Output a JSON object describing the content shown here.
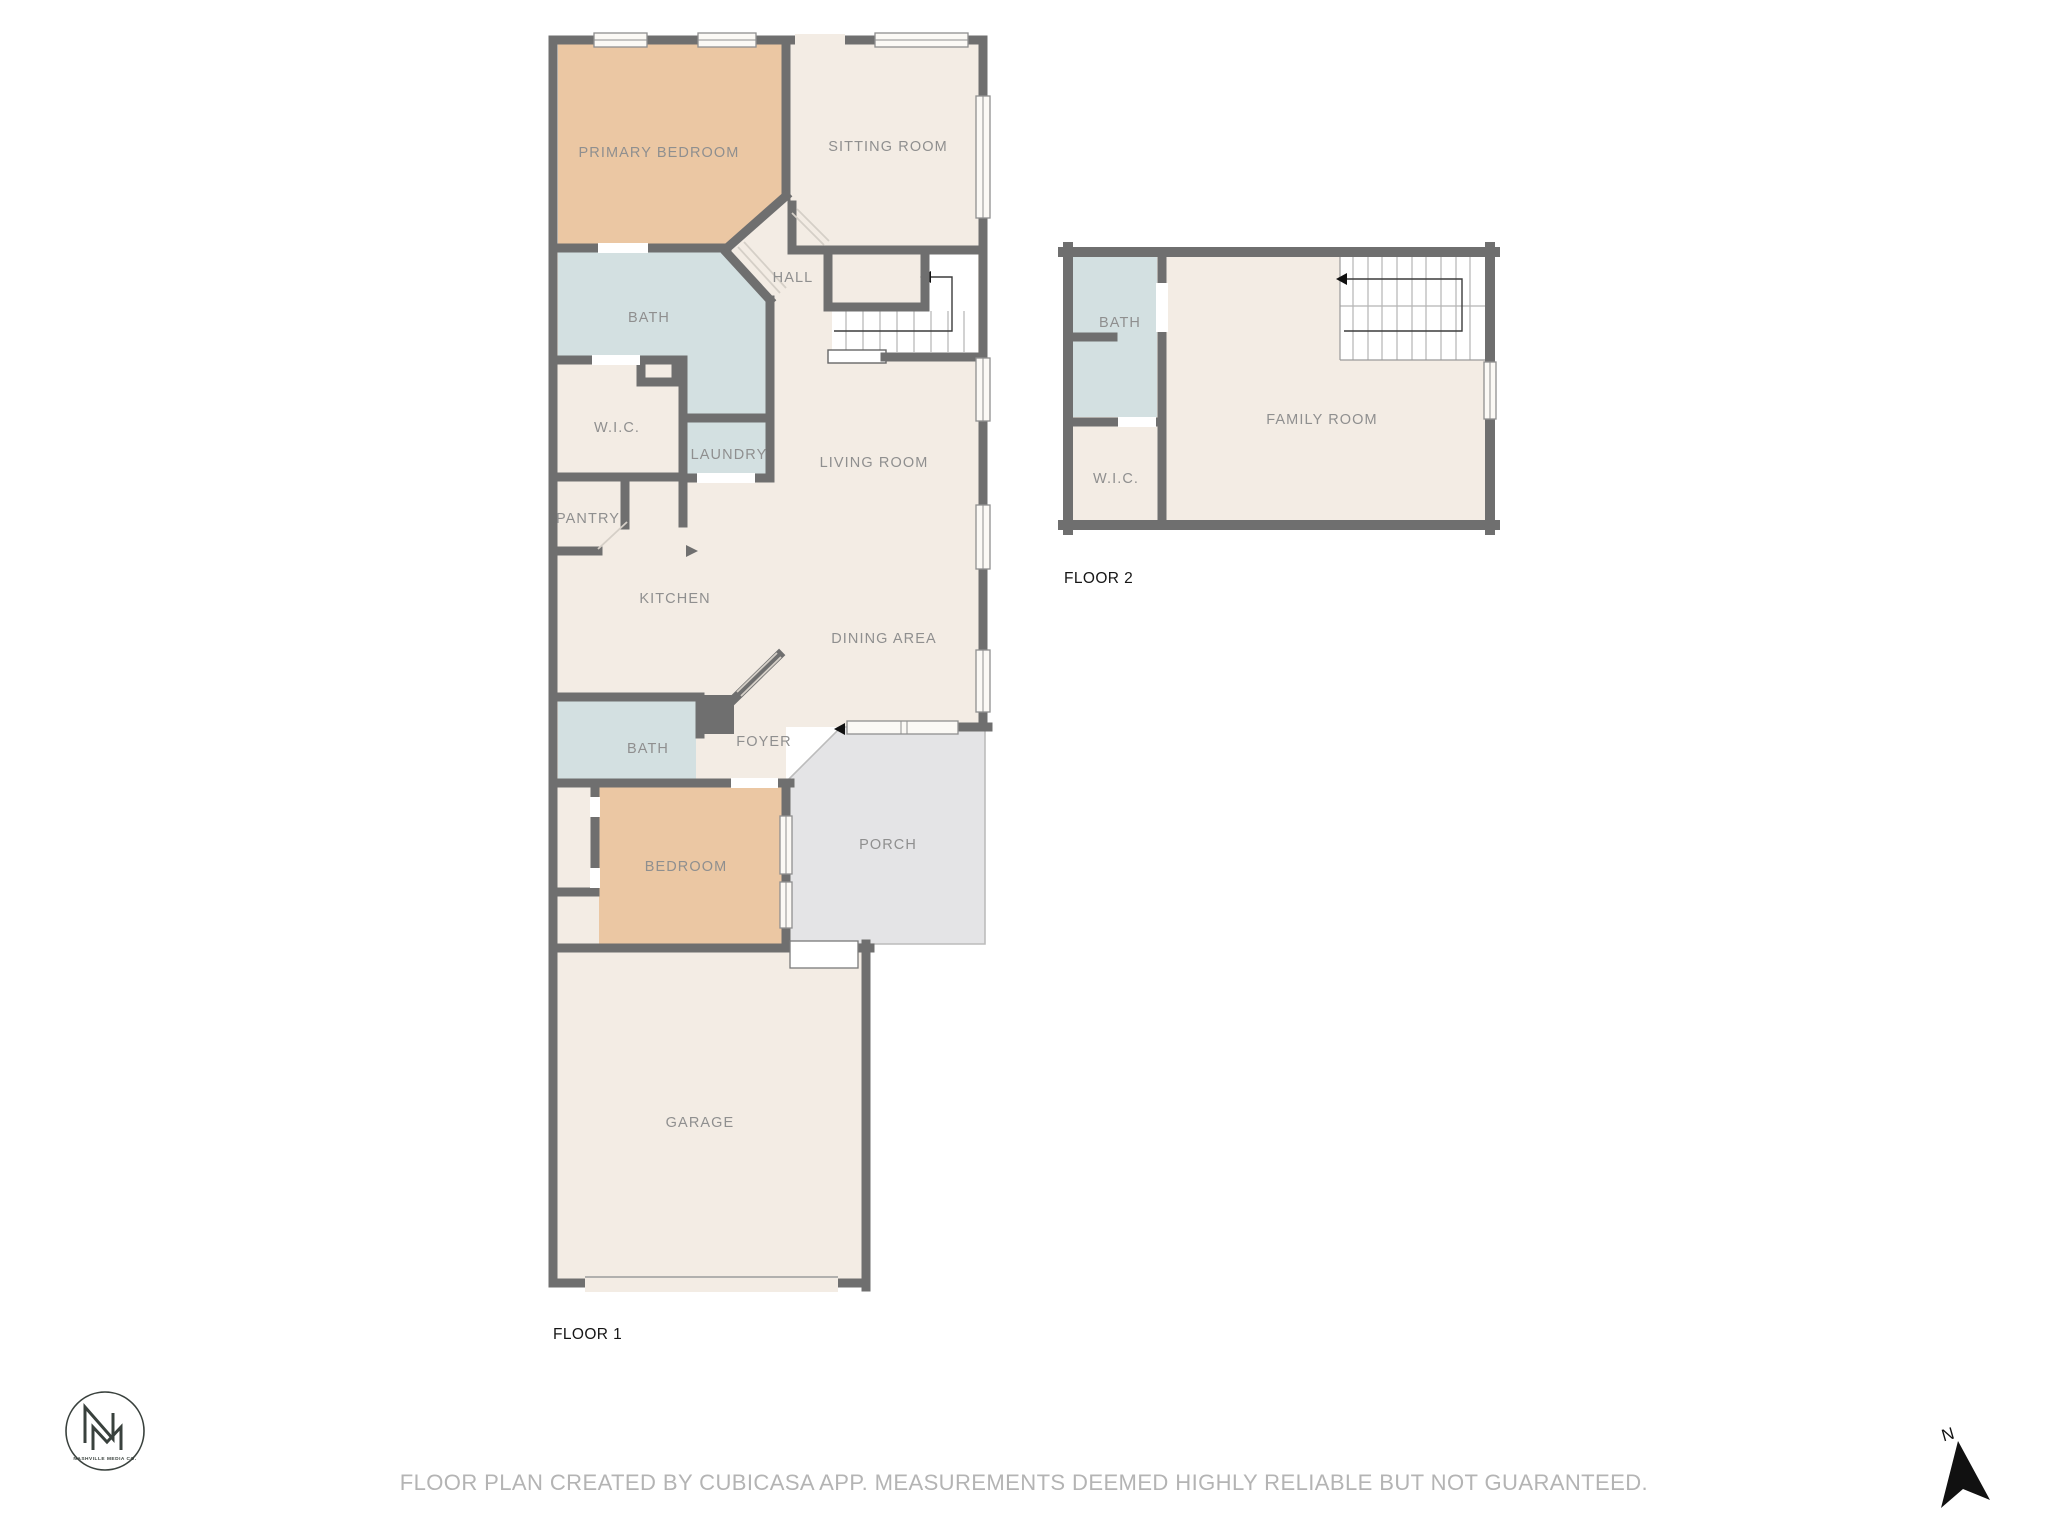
{
  "colors": {
    "wall": "#6f6f6f",
    "floor": "#f3ece4",
    "bedroom": "#ebc7a3",
    "bath": "#d3e0e1",
    "porch": "#e4e4e6",
    "label_text": "#8f8f8f",
    "footer_text": "#b4b4b4",
    "logo": "#39413d"
  },
  "floors": [
    {
      "label": "FLOOR 1",
      "rooms": [
        {
          "label": "PRIMARY BEDROOM"
        },
        {
          "label": "SITTING ROOM"
        },
        {
          "label": "HALL"
        },
        {
          "label": "BATH"
        },
        {
          "label": "W.I.C."
        },
        {
          "label": "LAUNDRY"
        },
        {
          "label": "LIVING ROOM"
        },
        {
          "label": "PANTRY"
        },
        {
          "label": "KITCHEN"
        },
        {
          "label": "DINING AREA"
        },
        {
          "label": "BATH"
        },
        {
          "label": "FOYER"
        },
        {
          "label": "PORCH"
        },
        {
          "label": "BEDROOM"
        },
        {
          "label": "GARAGE"
        }
      ]
    },
    {
      "label": "FLOOR 2",
      "rooms": [
        {
          "label": "BATH"
        },
        {
          "label": "W.I.C."
        },
        {
          "label": "FAMILY ROOM"
        }
      ]
    }
  ],
  "logo": {
    "initials": "NM",
    "name": "NASHVILLE MEDIA CO."
  },
  "compass": {
    "label": "N"
  },
  "footer": {
    "disclaimer": "FLOOR PLAN CREATED BY CUBICASA APP. MEASUREMENTS DEEMED HIGHLY RELIABLE BUT NOT GUARANTEED."
  }
}
